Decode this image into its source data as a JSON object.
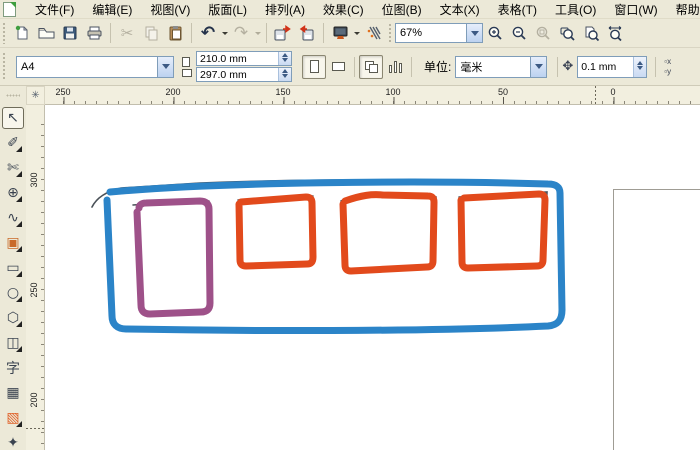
{
  "menu": {
    "items": [
      {
        "name": "menu-file",
        "label": "文件(F)"
      },
      {
        "name": "menu-edit",
        "label": "编辑(E)"
      },
      {
        "name": "menu-view",
        "label": "视图(V)"
      },
      {
        "name": "menu-layout",
        "label": "版面(L)"
      },
      {
        "name": "menu-arrange",
        "label": "排列(A)"
      },
      {
        "name": "menu-effects",
        "label": "效果(C)"
      },
      {
        "name": "menu-bitmaps",
        "label": "位图(B)"
      },
      {
        "name": "menu-text",
        "label": "文本(X)"
      },
      {
        "name": "menu-table",
        "label": "表格(T)"
      },
      {
        "name": "menu-tools",
        "label": "工具(O)"
      },
      {
        "name": "menu-window",
        "label": "窗口(W)"
      },
      {
        "name": "menu-help",
        "label": "帮助(H)"
      }
    ]
  },
  "toolbar": {
    "zoom_level": "67%",
    "icons": {
      "cut": "✂",
      "undo": "↶",
      "redo": "↷"
    }
  },
  "property_bar": {
    "paper_preset": "A4",
    "paper_width": "210.0 mm",
    "paper_height": "297.0 mm",
    "units_label": "单位:",
    "units_value": "毫米",
    "nudge_value": "0.1 mm",
    "nudge_icon_glyph": "✥",
    "dup_x_label": "▫x",
    "dup_y_label": "▫y"
  },
  "rulers": {
    "origin_glyph": "✳",
    "horizontal_labels": [
      {
        "text": "250",
        "x": 18
      },
      {
        "text": "200",
        "x": 128
      },
      {
        "text": "150",
        "x": 238
      },
      {
        "text": "100",
        "x": 348
      },
      {
        "text": "50",
        "x": 458
      },
      {
        "text": "0",
        "x": 568
      }
    ],
    "vertical_labels": [
      {
        "text": "300",
        "y": 75
      },
      {
        "text": "250",
        "y": 185
      },
      {
        "text": "200",
        "y": 295
      }
    ]
  },
  "toolbox": {
    "tools": [
      {
        "name": "pick-tool",
        "glyph": "↖",
        "selected": true
      },
      {
        "name": "shape-tool",
        "glyph": "✐",
        "flyout": true
      },
      {
        "name": "crop-tool",
        "glyph": "✄",
        "flyout": true
      },
      {
        "name": "zoom-tool",
        "glyph": "⊕",
        "flyout": true
      },
      {
        "name": "freehand-tool",
        "glyph": "∿",
        "flyout": true
      },
      {
        "name": "smart-fill-tool",
        "glyph": "▣",
        "flyout": true,
        "color": "#c96a2a"
      },
      {
        "name": "rectangle-tool",
        "glyph": "▭",
        "flyout": true
      },
      {
        "name": "ellipse-tool",
        "glyph": "○",
        "flyout": true
      },
      {
        "name": "polygon-tool",
        "glyph": "⬡",
        "flyout": true
      },
      {
        "name": "basic-shapes-tool",
        "glyph": "◫",
        "flyout": true
      },
      {
        "name": "text-tool",
        "glyph": "字"
      },
      {
        "name": "table-tool",
        "glyph": "▦"
      },
      {
        "name": "interactive-blend-tool",
        "glyph": "▧",
        "flyout": true,
        "color": "#e0622a"
      },
      {
        "name": "eyedropper-tool",
        "glyph": "✦"
      }
    ]
  },
  "canvas": {
    "colors": {
      "outer_frame_stroke": "#2b84c8",
      "first_box_stroke": "#9e5189",
      "orange_box_stroke": "#e24a1c",
      "pen_underlay_stroke": "#4a5158",
      "page_border": "#9f9c94",
      "paper": "#ffffff"
    },
    "shapes": [
      {
        "type": "hand-drawn-rectangle",
        "role": "outer-frame",
        "stroke": "#2b84c8"
      },
      {
        "type": "hand-drawn-rectangle",
        "role": "box-1",
        "stroke": "#9e5189"
      },
      {
        "type": "hand-drawn-rectangle",
        "role": "box-2",
        "stroke": "#e24a1c"
      },
      {
        "type": "hand-drawn-rectangle",
        "role": "box-3",
        "stroke": "#e24a1c"
      },
      {
        "type": "hand-drawn-rectangle",
        "role": "box-4",
        "stroke": "#e24a1c"
      }
    ]
  }
}
